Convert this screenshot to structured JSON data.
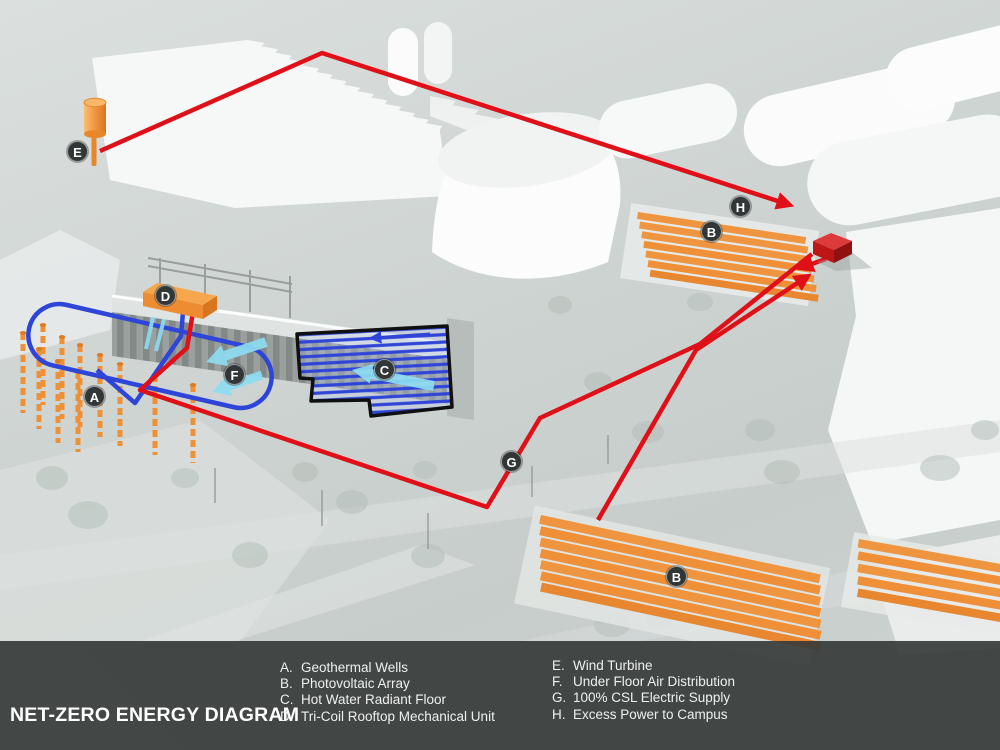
{
  "title": "NET-ZERO ENERGY DIAGRAM",
  "legend": {
    "left": [
      {
        "key": "A.",
        "label": "Geothermal Wells"
      },
      {
        "key": "B.",
        "label": "Photovoltaic Array"
      },
      {
        "key": "C.",
        "label": "Hot Water Radiant Floor"
      },
      {
        "key": "D.",
        "label": "Tri-Coil Rooftop Mechanical Unit"
      }
    ],
    "right": [
      {
        "key": "E.",
        "label": "Wind Turbine"
      },
      {
        "key": "F.",
        "label": "Under Floor Air Distribution"
      },
      {
        "key": "G.",
        "label": "100% CSL Electric Supply"
      },
      {
        "key": "H.",
        "label": "Excess Power to Campus"
      }
    ]
  },
  "markers": {
    "A": "A",
    "B_top": "B",
    "B_bottom": "B",
    "C": "C",
    "D": "D",
    "E": "E",
    "F": "F",
    "G": "G",
    "H": "H"
  },
  "colors": {
    "electric_red": "#e01018",
    "water_blue": "#2e45d8",
    "air_cyan": "#8edcf2",
    "equipment_orange": "#f0953f",
    "badge_bg": "#313637",
    "bottom_bar": "#3a3f3e"
  }
}
